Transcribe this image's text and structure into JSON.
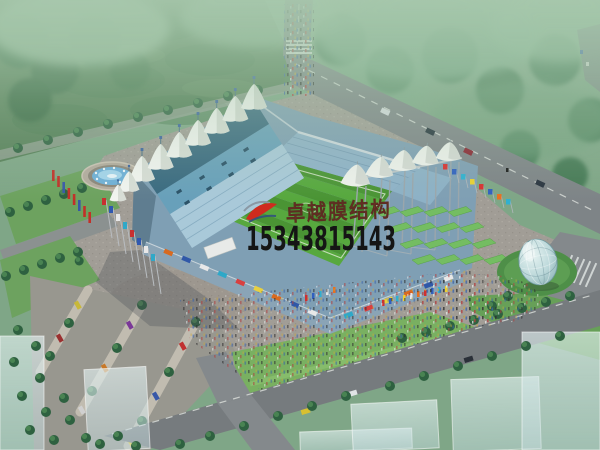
{
  "watermark": {
    "logo_icon": "red-swoosh-logo-icon",
    "company_name": "卓越膜结构",
    "phone_number": "15343815143",
    "company_color": "#6e3427",
    "phone_color": "#151515",
    "logo_red": "#cf2b1e",
    "logo_blue": "#31517e"
  },
  "scene": {
    "description": "aerial-rendering-membrane-roof-stadium",
    "palette": {
      "haze_green": "#a9c9ae",
      "canopy_green": "#4c7f5c",
      "field_green": "#567f58",
      "pitch_green": "#55a53e",
      "lawn_green": "#79b061",
      "terrace_green": "#74bd62",
      "roof_blue_dark": "#3a6a80",
      "roof_blue": "#68a0ba",
      "seating_blue": "#a9c9d9",
      "membrane_white": "#f2f4f0",
      "road_gray": "#7e8487",
      "plaza_gray": "#a19d96",
      "water_blue": "#6fb0d8",
      "dome_glass": "#bcd8da",
      "ghost_building": "#deeeee"
    }
  }
}
